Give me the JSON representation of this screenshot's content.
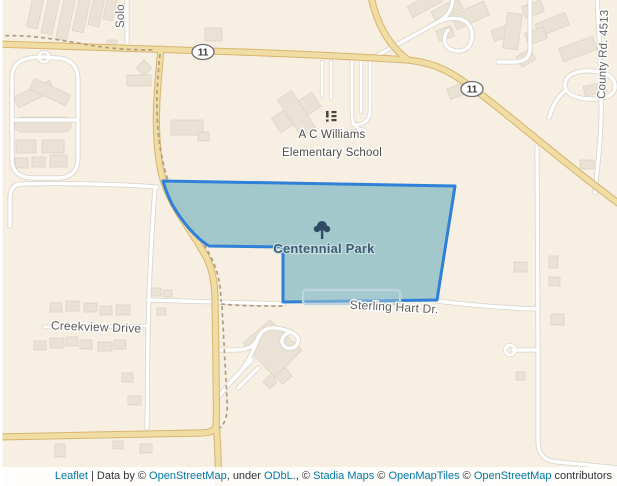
{
  "map": {
    "park": {
      "name": "Centennial Park"
    },
    "school": {
      "line1": "A C Williams",
      "line2": "Elementary School"
    },
    "streets": {
      "solo": "Solo",
      "county": "County Rd. 4513",
      "creekview": "Creekview Drive",
      "sterling": "Sterling Hart Dr."
    },
    "route_shields": {
      "west": "11",
      "east": "11"
    },
    "colors": {
      "land": "#f7efe2",
      "building": "#e9e2d5",
      "highway": "#efdda3",
      "highway_casing": "#d9b472",
      "minor_road": "#ffffff",
      "minor_road_casing": "#d9d4c9",
      "foot_path": "#b39c85",
      "park_fill": "#9dc5c9",
      "park_border": "#2e80d8",
      "street_label": "#5d5d5d",
      "park_label": "#3a5d72",
      "link_blue": "#0078a8"
    }
  },
  "attribution": {
    "leaflet": "Leaflet",
    "d1": " | Data by © ",
    "osm1": "OpenStreetMap",
    "d2": ", under ",
    "odbl": "ODbL.",
    "d3": ", © ",
    "stadia": "Stadia Maps",
    "d4": " © ",
    "omt": "OpenMapTiles",
    "d5": " © ",
    "osm2": "OpenStreetMap",
    "d6": " contributors"
  }
}
